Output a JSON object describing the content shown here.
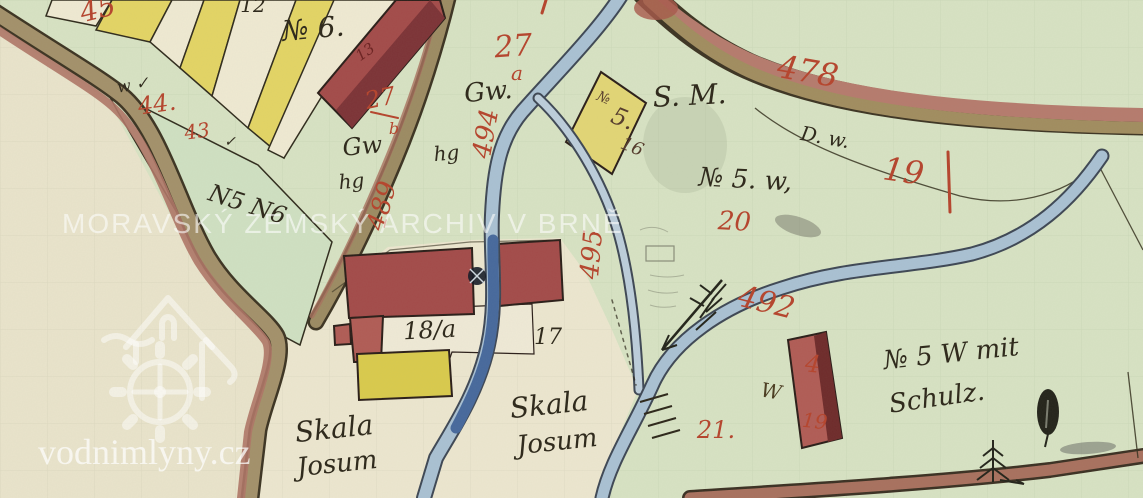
{
  "watermarks": {
    "archive": "MORAVSKÝ ZEMSKÝ ARCHIV V BRNĚ",
    "site": "vodnimlyny.cz"
  },
  "colors": {
    "paper_green": "#d7e2c3",
    "paper_cream": "#e9e3cb",
    "parcel_green": "#cfe0c2",
    "field_yellow": "#e3d464",
    "building_red": "#a34a49",
    "building_yellow": "#d9ca4c",
    "road_tan": "#a3906a",
    "road_redbrown": "#ae7466",
    "stream_blue": "#a9c0d3",
    "millrace_dark_blue": "#46689c",
    "ink_red": "#b5432c",
    "ink_black": "#2c2619"
  },
  "labels": {
    "red": {
      "n45": "45",
      "n44": "44.",
      "n43": "43",
      "n27": "27",
      "n27a": "a",
      "frac27_num": "27",
      "frac27_den": "b",
      "n489": "489",
      "n494": "494",
      "n478": "478",
      "n19_road": "19",
      "n495": "495",
      "n492": "492",
      "n20": "20",
      "n21": "21.",
      "house4": "4",
      "house4_19": "19",
      "n13": "13"
    },
    "black": {
      "n12": "12",
      "no6": "№ 6.",
      "w_check": "w ✓",
      "check": "✓",
      "n5n6": "N5 N6",
      "gw1": "Gw.",
      "gw2": "Gw",
      "hg1": "hg",
      "hg2": "hg",
      "sm": "S. M.",
      "dw": "D. w.",
      "no5w": "№ 5. w,",
      "bno": "№",
      "b5": "5.",
      "b16": "16",
      "n18a": "18/a",
      "n17": "17",
      "skala1_line1": "Skala",
      "skala1_line2": "Josum",
      "skala2_line1": "Skala",
      "skala2_line2": "Josum",
      "no5wmit": "№ 5 W mit",
      "schulz": "Schulz.",
      "w_house": "W"
    }
  }
}
